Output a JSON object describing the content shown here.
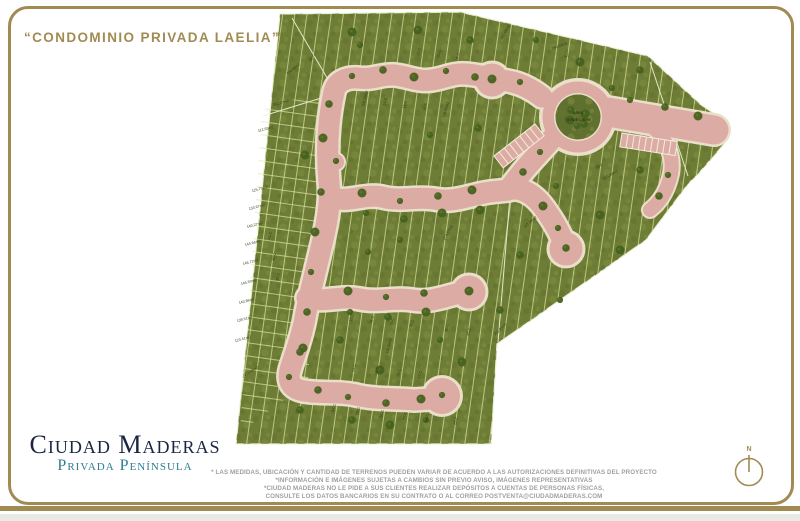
{
  "title": "“CONDOMINIO PRIVADA LAELIA”",
  "brand": {
    "name": "Ciudad Maderas",
    "subtitle": "Privada Península"
  },
  "disclaimer": {
    "line1": "* LAS MEDIDAS, UBICACIÓN Y CANTIDAD DE TERRENOS PUEDEN VARIAR DE ACUERDO A LAS AUTORIZACIONES DEFINITIVAS DEL PROYECTO",
    "line2": "*INFORMACIÓN E IMÁGENES SUJETAS A CAMBIOS SIN PREVIO AVISO, IMÁGENES REPRESENTATIVAS",
    "line3": "*CIUDAD MADERAS NO LE PIDE A SUS CLIENTES REALIZAR DEPÓSITOS A CUENTAS DE PERSONAS FÍSICAS,",
    "line4": "CONSULTE LOS DATOS BANCARIOS EN SU CONTRATO O AL CORREO POSTVENTA@CIUDADMADERAS.COM"
  },
  "compass": {
    "label": "N"
  },
  "map": {
    "roundabout_label": {
      "line1": "AREA",
      "line2": "VERDE LIBRE"
    },
    "lot_labels": [
      {
        "t": "234.84m2",
        "x": 294,
        "y": 70,
        "r": -40
      },
      {
        "t": "261.27m2",
        "x": 281,
        "y": 104,
        "r": -15
      },
      {
        "t": "112.65m2",
        "x": 266,
        "y": 130,
        "r": -15
      },
      {
        "t": "125.70m2",
        "x": 260,
        "y": 190,
        "r": -15
      },
      {
        "t": "133.67m2",
        "x": 257,
        "y": 208,
        "r": -15
      },
      {
        "t": "140.27m2",
        "x": 255,
        "y": 226,
        "r": -15
      },
      {
        "t": "144.66m2",
        "x": 253,
        "y": 244,
        "r": -15
      },
      {
        "t": "146.72m2",
        "x": 251,
        "y": 263,
        "r": -15
      },
      {
        "t": "146.50m2",
        "x": 249,
        "y": 283,
        "r": -15
      },
      {
        "t": "143.86m2",
        "x": 247,
        "y": 302,
        "r": -15
      },
      {
        "t": "139.51m2",
        "x": 245,
        "y": 320,
        "r": -15
      },
      {
        "t": "123.41m2",
        "x": 243,
        "y": 340,
        "r": -15
      },
      {
        "t": "270.65m2",
        "x": 252,
        "y": 372,
        "r": -30
      },
      {
        "t": "44-C",
        "x": 271,
        "y": 236,
        "r": -75
      },
      {
        "t": "43-C",
        "x": 275,
        "y": 257,
        "r": -75
      },
      {
        "t": "42-C",
        "x": 279,
        "y": 277,
        "r": -75
      },
      {
        "t": "32-C",
        "x": 313,
        "y": 58,
        "r": -60
      },
      {
        "t": "27-C",
        "x": 420,
        "y": 52,
        "r": -75
      },
      {
        "t": "26-C",
        "x": 440,
        "y": 54,
        "r": -75
      },
      {
        "t": "25-C",
        "x": 459,
        "y": 57,
        "r": -75
      },
      {
        "t": "191.68m2",
        "x": 506,
        "y": 33,
        "r": -60
      },
      {
        "t": "266.86m2",
        "x": 560,
        "y": 47,
        "r": -20
      },
      {
        "t": "4-C",
        "x": 567,
        "y": 57,
        "r": -20
      },
      {
        "t": "14-C",
        "x": 386,
        "y": 102,
        "r": -75
      },
      {
        "t": "15-C",
        "x": 406,
        "y": 105,
        "r": -75
      },
      {
        "t": "16-C",
        "x": 426,
        "y": 107,
        "r": -75
      },
      {
        "t": "118.50m2",
        "x": 447,
        "y": 110,
        "r": -75
      },
      {
        "t": "108.52m2",
        "x": 366,
        "y": 99,
        "r": -75
      },
      {
        "t": "33-C",
        "x": 600,
        "y": 167,
        "r": -30
      },
      {
        "t": "223.85m2",
        "x": 611,
        "y": 176,
        "r": -30
      },
      {
        "t": "112.35m2",
        "x": 531,
        "y": 223,
        "r": -40
      },
      {
        "t": "273.57m2",
        "x": 449,
        "y": 233,
        "r": -60
      },
      {
        "t": "253.83m2",
        "x": 501,
        "y": 330,
        "r": -45
      },
      {
        "t": "73-C",
        "x": 353,
        "y": 318,
        "r": -75
      },
      {
        "t": "74-C",
        "x": 373,
        "y": 320,
        "r": -75
      },
      {
        "t": "75-C",
        "x": 393,
        "y": 322,
        "r": -75
      },
      {
        "t": "76-C",
        "x": 413,
        "y": 324,
        "r": -75
      },
      {
        "t": "80-C",
        "x": 448,
        "y": 328,
        "r": -75
      },
      {
        "t": "83-C",
        "x": 470,
        "y": 332,
        "r": -75
      },
      {
        "t": "119.50m2",
        "x": 390,
        "y": 346,
        "r": -75
      },
      {
        "t": "64-C",
        "x": 355,
        "y": 368,
        "r": -75
      },
      {
        "t": "65-C",
        "x": 378,
        "y": 371,
        "r": -75
      },
      {
        "t": "66-C",
        "x": 400,
        "y": 373,
        "r": -75
      },
      {
        "t": "67-C",
        "x": 421,
        "y": 375,
        "r": -75
      },
      {
        "t": "54-C",
        "x": 335,
        "y": 408,
        "r": -75
      },
      {
        "t": "55-C",
        "x": 359,
        "y": 411,
        "r": -75
      },
      {
        "t": "56-C",
        "x": 383,
        "y": 414,
        "r": -75
      },
      {
        "t": "57-C",
        "x": 406,
        "y": 416,
        "r": -75
      },
      {
        "t": "58-C",
        "x": 428,
        "y": 418,
        "r": -75
      },
      {
        "t": "82-C",
        "x": 457,
        "y": 421,
        "r": -75
      }
    ]
  },
  "colors": {
    "gold": "#a18b52",
    "navy": "#1a2742",
    "teal": "#2c7d92",
    "gray": "#9f9f9f",
    "grass": "#6e7d36",
    "road": "#dcaba4",
    "road_edge": "#eadfc9",
    "tree": "#46611f",
    "lot_line": "#dfeaa6"
  }
}
